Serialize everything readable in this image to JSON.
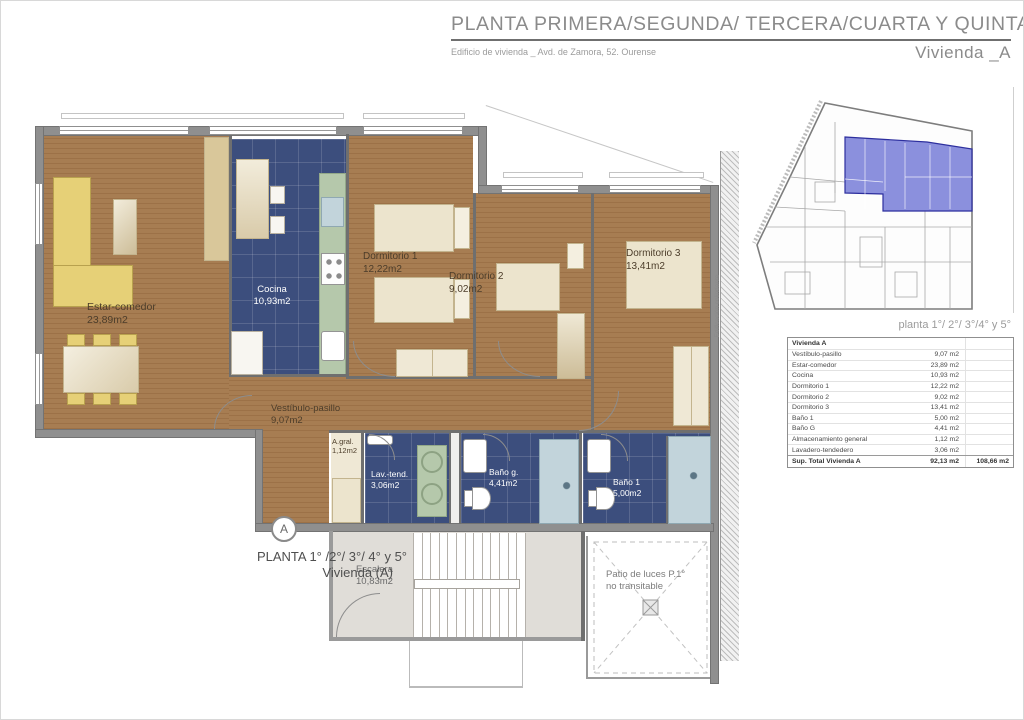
{
  "header": {
    "title": "PLANTA PRIMERA/SEGUNDA/ TERCERA/CUARTA Y QUINTA",
    "subtitle": "Edificio de vivienda _ Avd. de Zamora, 52. Ourense",
    "unit": "Vivienda _A"
  },
  "plan": {
    "rooms": {
      "estar": {
        "name": "Estar-comedor",
        "area": "23,89m2"
      },
      "cocina": {
        "name": "Cocina",
        "area": "10,93m2"
      },
      "dorm1": {
        "name": "Dormitorio 1",
        "area": "12,22m2"
      },
      "dorm2": {
        "name": "Dormitorio 2",
        "area": "9,02m2"
      },
      "dorm3": {
        "name": "Dormitorio 3",
        "area": "13,41m2"
      },
      "hall": {
        "name": "Vestíbulo-pasillo",
        "area": "9,07m2"
      },
      "agral": {
        "name": "A.gral.",
        "area": "1,12m2"
      },
      "lav": {
        "name": "Lav.-tend.",
        "area": "3,06m2"
      },
      "banog": {
        "name": "Baño g.",
        "area": "4,41m2"
      },
      "bano1": {
        "name": "Baño 1",
        "area": "5,00m2"
      },
      "escalera": {
        "name": "Escalera",
        "area": "10,83m2"
      }
    },
    "patio": {
      "line1": "Patio de luces P.1°",
      "line2": "no transitable"
    },
    "side_label": "Edificación colindante",
    "marker": "A",
    "floor_label_line1": "PLANTA 1° /2°/ 3°/ 4° y 5°",
    "floor_label_line2": "Vivienda  (A)"
  },
  "overview": {
    "caption": "planta 1°/ 2°/ 3°/4° y 5°"
  },
  "table": {
    "header": "Vivienda A",
    "rows": [
      {
        "label": "Vestíbulo-pasillo",
        "value": "9,07 m2"
      },
      {
        "label": "Estar-comedor",
        "value": "23,89 m2"
      },
      {
        "label": "Cocina",
        "value": "10,93 m2"
      },
      {
        "label": "Dormitorio 1",
        "value": "12,22 m2"
      },
      {
        "label": "Dormitorio 2",
        "value": "9,02 m2"
      },
      {
        "label": "Dormitorio 3",
        "value": "13,41 m2"
      },
      {
        "label": "Baño 1",
        "value": "5,00 m2"
      },
      {
        "label": "Baño G",
        "value": "4,41 m2"
      },
      {
        "label": "Almacenamiento general",
        "value": "1,12 m2"
      },
      {
        "label": "Lavadero-tendedero",
        "value": "3,06 m2"
      }
    ],
    "total": {
      "label": "Sup. Total Vivienda A",
      "value": "92,13 m2",
      "value2": "108,66 m2"
    }
  },
  "colors": {
    "highlight_blue": "#7178d6",
    "tile_blue": "#3c4e7d",
    "wood": "#a77d52"
  }
}
